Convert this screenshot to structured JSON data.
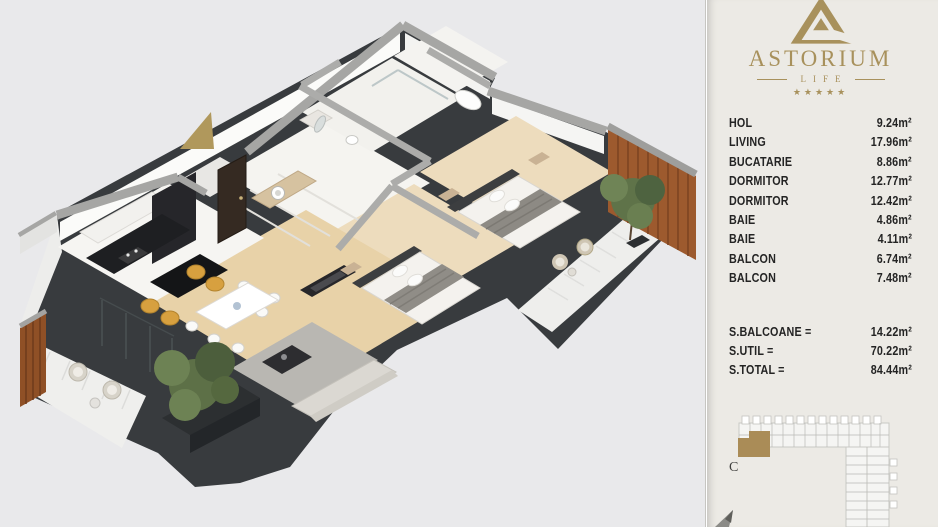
{
  "branding": {
    "name": "ASTORIUM",
    "subtitle": "LIFE",
    "stars": "★★★★★"
  },
  "colors": {
    "gold": "#a8915c",
    "panel_bg": "#eceae5",
    "canvas_bg": "#e9e9eb",
    "text": "#242424",
    "slab_charcoal": "#383b3e",
    "wood_accent": "#9d5a2e"
  },
  "rooms": [
    {
      "label": "HOL",
      "area": "9.24m²"
    },
    {
      "label": "LIVING",
      "area": "17.96m²"
    },
    {
      "label": "BUCATARIE",
      "area": "8.86m²"
    },
    {
      "label": "DORMITOR",
      "area": "12.77m²"
    },
    {
      "label": "DORMITOR",
      "area": "12.42m²"
    },
    {
      "label": "BAIE",
      "area": "4.86m²"
    },
    {
      "label": "BAIE",
      "area": "4.11m²"
    },
    {
      "label": "BALCON",
      "area": "6.74m²"
    },
    {
      "label": "BALCON",
      "area": "7.48m²"
    }
  ],
  "totals": [
    {
      "label": "S.BALCOANE =",
      "value": "14.22m²"
    },
    {
      "label": "S.UTIL =",
      "value": "70.22m²"
    },
    {
      "label": "S.TOTAL =",
      "value": "84.44m²"
    }
  ],
  "site_plan": {
    "block_label": "C"
  }
}
